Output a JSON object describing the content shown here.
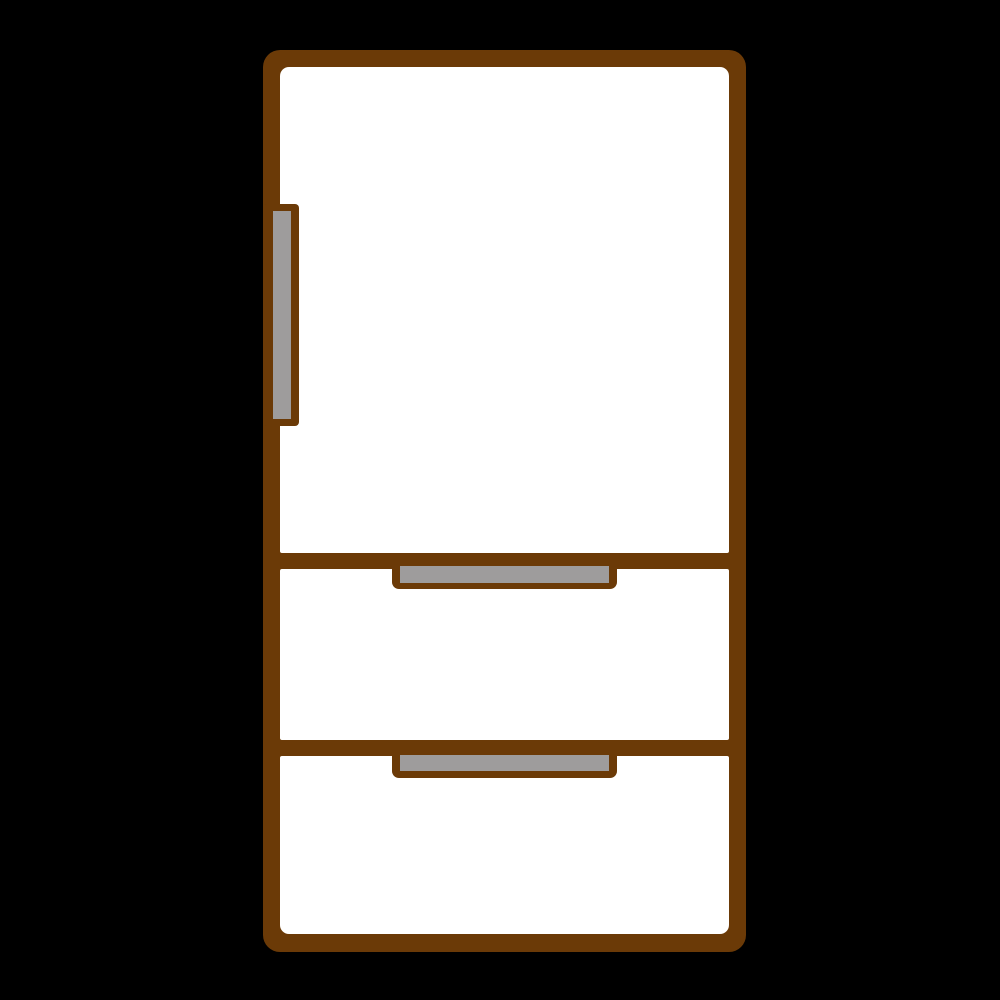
{
  "illustration": {
    "type": "clipart",
    "subject": "refrigerator",
    "description": "Flat clip-art drawing of a three-section refrigerator: one large door with a vertical handle and two pull-out drawers with horizontal handle bars",
    "colors": {
      "background": "#000000",
      "outline": "#6b3a07",
      "body": "#ffffff",
      "handle": "#9e9c9c"
    }
  }
}
